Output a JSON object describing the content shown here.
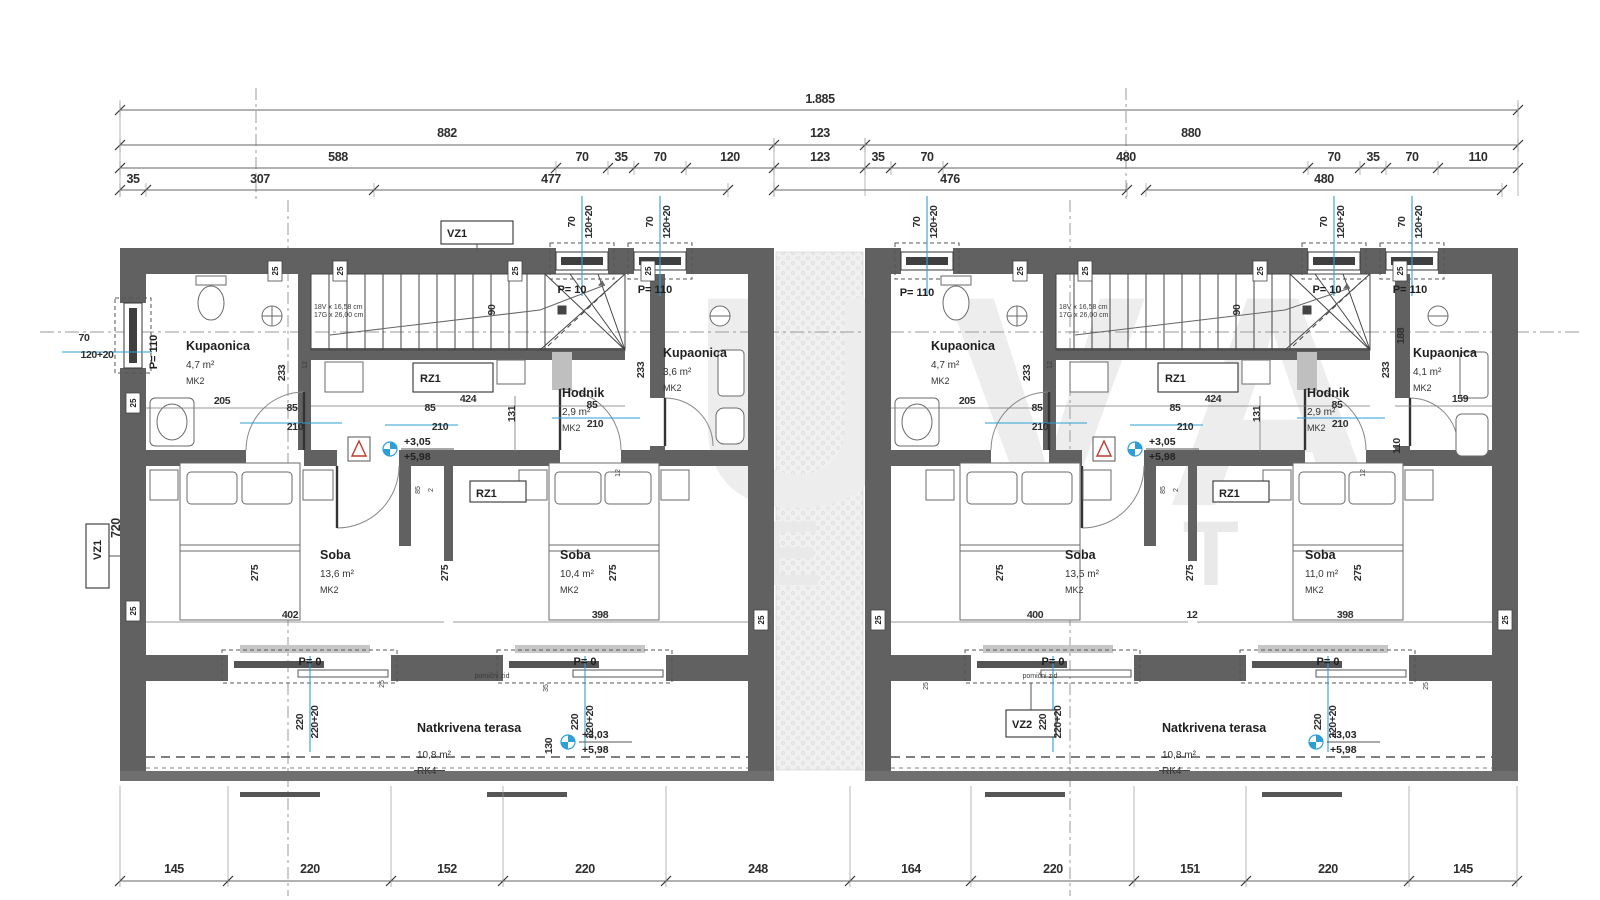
{
  "watermark": {
    "big": "UVA",
    "small": "EST"
  },
  "rooms": [
    {
      "name": "Kupaonica",
      "area": "4,7 m²",
      "cls": "MK2",
      "x": 186,
      "y": 350
    },
    {
      "name": "Hodnik",
      "area": "2,9 m²",
      "cls": "MK2",
      "x": 562,
      "y": 397
    },
    {
      "name": "Kupaonica",
      "area": "3,6 m²",
      "cls": "MK2",
      "x": 663,
      "y": 357
    },
    {
      "name": "Soba",
      "area": "13,6 m²",
      "cls": "MK2",
      "x": 320,
      "y": 559
    },
    {
      "name": "Soba",
      "area": "10,4 m²",
      "cls": "MK2",
      "x": 560,
      "y": 559
    },
    {
      "name": "Kupaonica",
      "area": "4,7 m²",
      "cls": "MK2",
      "x": 931,
      "y": 350
    },
    {
      "name": "Hodnik",
      "area": "2,9 m²",
      "cls": "MK2",
      "x": 1307,
      "y": 397
    },
    {
      "name": "Kupaonica",
      "area": "4,1 m²",
      "cls": "MK2",
      "x": 1413,
      "y": 357
    },
    {
      "name": "Soba",
      "area": "13,5 m²",
      "cls": "MK2",
      "x": 1065,
      "y": 559
    },
    {
      "name": "Soba",
      "area": "11,0 m²",
      "cls": "MK2",
      "x": 1305,
      "y": 559
    }
  ],
  "terrace": [
    {
      "name": "Natkrivena terasa",
      "area": "10,8 m²",
      "note": "RK4",
      "x": 417,
      "y": 732
    },
    {
      "name": "Natkrivena terasa",
      "area": "10,8 m²",
      "note": "RK4",
      "x": 1162,
      "y": 732
    }
  ],
  "levels": [
    {
      "x": 390,
      "y": 449,
      "above": "+3,05",
      "below": "+5,98"
    },
    {
      "x": 1135,
      "y": 449,
      "above": "+3,05",
      "below": "+5,98"
    },
    {
      "x": 568,
      "y": 742,
      "above": "+3,03",
      "below": "+5,98"
    },
    {
      "x": 1316,
      "y": 742,
      "above": "+3,03",
      "below": "+5,98"
    }
  ],
  "stairs_text": [
    {
      "l1": "18V x 16,58 cm",
      "l2": "17G x 26,00 cm",
      "x": 314,
      "y": 309
    },
    {
      "l1": "18V x 16,58 cm",
      "l2": "17G x 26,00 cm",
      "x": 1059,
      "y": 309
    }
  ],
  "code_boxes": [
    [
      "RZ1",
      413,
      363,
      80,
      29,
      420,
      382,
      0
    ],
    [
      "RZ1",
      470,
      481,
      56,
      21,
      476,
      497,
      0
    ],
    [
      "RZ1",
      1158,
      363,
      80,
      29,
      1165,
      382,
      0
    ],
    [
      "RZ1",
      1213,
      481,
      56,
      21,
      1219,
      497,
      0
    ],
    [
      "VZ1",
      441,
      221,
      72,
      23,
      447,
      237,
      0
    ],
    [
      "VZ2",
      1006,
      710,
      50,
      27,
      1012,
      728,
      0
    ],
    [
      "VZ1",
      86,
      524,
      23,
      64,
      101,
      560,
      -90
    ]
  ],
  "wall_markers": [
    {
      "t": "25",
      "x": 275,
      "y": 271
    },
    {
      "t": "25",
      "x": 340,
      "y": 271
    },
    {
      "t": "25",
      "x": 515,
      "y": 271
    },
    {
      "t": "25",
      "x": 648,
      "y": 271
    },
    {
      "t": "25",
      "x": 1020,
      "y": 271
    },
    {
      "t": "25",
      "x": 1085,
      "y": 271
    },
    {
      "t": "25",
      "x": 1260,
      "y": 271
    },
    {
      "t": "25",
      "x": 1400,
      "y": 271
    },
    {
      "t": "25",
      "x": 133,
      "y": 403
    },
    {
      "t": "25",
      "x": 133,
      "y": 611
    },
    {
      "t": "25",
      "x": 761,
      "y": 620
    },
    {
      "t": "25",
      "x": 878,
      "y": 620
    },
    {
      "t": "25",
      "x": 1505,
      "y": 620
    }
  ],
  "labels": {
    "dims_row1": [
      [
        "1.885",
        820,
        103,
        "d"
      ]
    ],
    "dims_row2": [
      [
        "882",
        447,
        137,
        "d"
      ],
      [
        "123",
        820,
        137,
        "d"
      ],
      [
        "880",
        1191,
        137,
        "d"
      ]
    ],
    "dims_row3": [
      [
        "588",
        338,
        161,
        "d"
      ],
      [
        "70",
        582,
        161,
        "d"
      ],
      [
        "35",
        621,
        161,
        "d"
      ],
      [
        "70",
        660,
        161,
        "d"
      ],
      [
        "120",
        730,
        161,
        "d"
      ],
      [
        "123",
        820,
        161,
        "d"
      ],
      [
        "35",
        878,
        161,
        "d"
      ],
      [
        "70",
        927,
        161,
        "d"
      ],
      [
        "480",
        1126,
        161,
        "d"
      ],
      [
        "70",
        1334,
        161,
        "d"
      ],
      [
        "35",
        1373,
        161,
        "d"
      ],
      [
        "70",
        1412,
        161,
        "d"
      ],
      [
        "110",
        1478,
        161,
        "d"
      ]
    ],
    "dims_row4": [
      [
        "35",
        133,
        183,
        "d"
      ],
      [
        "307",
        260,
        183,
        "d"
      ],
      [
        "477",
        551,
        183,
        "d"
      ],
      [
        "476",
        950,
        183,
        "d"
      ],
      [
        "480",
        1324,
        183,
        "d"
      ]
    ],
    "dims_bottom": [
      [
        "145",
        174,
        873,
        "d"
      ],
      [
        "220",
        310,
        873,
        "d"
      ],
      [
        "152",
        447,
        873,
        "d"
      ],
      [
        "220",
        585,
        873,
        "d"
      ],
      [
        "248",
        758,
        873,
        "d"
      ],
      [
        "164",
        911,
        873,
        "d"
      ],
      [
        "220",
        1053,
        873,
        "d"
      ],
      [
        "151",
        1190,
        873,
        "d"
      ],
      [
        "220",
        1328,
        873,
        "d"
      ],
      [
        "145",
        1463,
        873,
        "d"
      ]
    ],
    "window_dims": [
      [
        "70",
        575,
        222,
        "ds",
        -90
      ],
      [
        "120+20",
        592,
        222,
        "ds",
        -90
      ],
      [
        "70",
        653,
        222,
        "ds",
        -90
      ],
      [
        "120+20",
        670,
        222,
        "ds",
        -90
      ],
      [
        "70",
        920,
        222,
        "ds",
        -90
      ],
      [
        "120+20",
        937,
        222,
        "ds",
        -90
      ],
      [
        "70",
        1327,
        222,
        "ds",
        -90
      ],
      [
        "120+20",
        1344,
        222,
        "ds",
        -90
      ],
      [
        "70",
        1405,
        222,
        "ds",
        -90
      ],
      [
        "120+20",
        1422,
        222,
        "ds",
        -90
      ],
      [
        "70",
        84,
        341,
        "ds",
        0
      ],
      [
        "120+20",
        97,
        358,
        "ds",
        0
      ]
    ],
    "opening_codes": [
      [
        "P= 10",
        572,
        293,
        "c",
        0
      ],
      [
        "P= 110",
        655,
        293,
        "c",
        0
      ],
      [
        "P= 110",
        917,
        296,
        "c",
        0
      ],
      [
        "P= 10",
        1327,
        293,
        "c",
        0
      ],
      [
        "P= 110",
        1410,
        293,
        "c",
        0
      ],
      [
        "P= 110",
        157,
        352,
        "c",
        -90
      ],
      [
        "P= 0",
        310,
        665,
        "c",
        0
      ],
      [
        "P= 0",
        585,
        665,
        "c",
        0
      ],
      [
        "P= 0",
        1053,
        665,
        "c",
        0
      ],
      [
        "P= 0",
        1328,
        665,
        "c",
        0
      ]
    ],
    "slider_dims": [
      [
        "220",
        303,
        722,
        "ds",
        -90
      ],
      [
        "220+20",
        318,
        722,
        "ds",
        -90
      ],
      [
        "220",
        578,
        722,
        "ds",
        -90
      ],
      [
        "220+20",
        593,
        722,
        "ds",
        -90
      ],
      [
        "220",
        1046,
        722,
        "ds",
        -90
      ],
      [
        "220+20",
        1061,
        722,
        "ds",
        -90
      ],
      [
        "220",
        1321,
        722,
        "ds",
        -90
      ],
      [
        "220+20",
        1336,
        722,
        "ds",
        -90
      ]
    ],
    "interior_dims": [
      [
        "205",
        222,
        404,
        "ds",
        0
      ],
      [
        "85",
        292,
        411,
        "ds",
        0
      ],
      [
        "210",
        295,
        430,
        "ds",
        0
      ],
      [
        "424",
        468,
        402,
        "ds",
        0
      ],
      [
        "85",
        430,
        411,
        "ds",
        0
      ],
      [
        "210",
        440,
        430,
        "ds",
        0
      ],
      [
        "131",
        515,
        414,
        "ds",
        -90
      ],
      [
        "85",
        592,
        408,
        "ds",
        0
      ],
      [
        "210",
        595,
        427,
        "ds",
        0
      ],
      [
        "233",
        285,
        373,
        "ds",
        -90
      ],
      [
        "233",
        644,
        370,
        "ds",
        -90
      ],
      [
        "12",
        307,
        365,
        "t",
        -90
      ],
      [
        "12",
        620,
        473,
        "t",
        -90
      ],
      [
        "90",
        495,
        310,
        "ds",
        -90
      ],
      [
        "402",
        290,
        618,
        "ds",
        0
      ],
      [
        "398",
        600,
        618,
        "ds",
        0
      ],
      [
        "275",
        258,
        573,
        "ds",
        -90
      ],
      [
        "275",
        448,
        573,
        "ds",
        -90
      ],
      [
        "275",
        616,
        573,
        "ds",
        -90
      ],
      [
        "85",
        420,
        490,
        "t",
        -90
      ],
      [
        "2",
        433,
        490,
        "t",
        -90
      ],
      [
        "720",
        120,
        528,
        "d",
        -90
      ],
      [
        "130",
        552,
        746,
        "ds",
        -90
      ],
      [
        "25",
        384,
        684,
        "t",
        -90
      ],
      [
        "35",
        548,
        688,
        "t",
        -90
      ],
      [
        "205",
        967,
        404,
        "ds",
        0
      ],
      [
        "85",
        1037,
        411,
        "ds",
        0
      ],
      [
        "210",
        1040,
        430,
        "ds",
        0
      ],
      [
        "424",
        1213,
        402,
        "ds",
        0
      ],
      [
        "85",
        1175,
        411,
        "ds",
        0
      ],
      [
        "210",
        1185,
        430,
        "ds",
        0
      ],
      [
        "131",
        1260,
        414,
        "ds",
        -90
      ],
      [
        "85",
        1337,
        408,
        "ds",
        0
      ],
      [
        "210",
        1340,
        427,
        "ds",
        0
      ],
      [
        "233",
        1030,
        373,
        "ds",
        -90
      ],
      [
        "233",
        1389,
        370,
        "ds",
        -90
      ],
      [
        "12",
        1052,
        365,
        "t",
        -90
      ],
      [
        "12",
        1365,
        473,
        "t",
        -90
      ],
      [
        "90",
        1240,
        310,
        "ds",
        -90
      ],
      [
        "400",
        1035,
        618,
        "ds",
        0
      ],
      [
        "12",
        1192,
        618,
        "ds",
        0
      ],
      [
        "398",
        1345,
        618,
        "ds",
        0
      ],
      [
        "275",
        1003,
        573,
        "ds",
        -90
      ],
      [
        "275",
        1193,
        573,
        "ds",
        -90
      ],
      [
        "275",
        1361,
        573,
        "ds",
        -90
      ],
      [
        "85",
        1165,
        490,
        "t",
        -90
      ],
      [
        "2",
        1178,
        490,
        "t",
        -90
      ],
      [
        "110",
        1400,
        446,
        "ds",
        -90
      ],
      [
        "188",
        1404,
        336,
        "ds",
        -90
      ],
      [
        "159",
        1460,
        402,
        "ds",
        0
      ],
      [
        "25",
        928,
        686,
        "t",
        -90
      ],
      [
        "25",
        1428,
        686,
        "t",
        -90
      ]
    ],
    "notes": [
      [
        "pomični zid",
        492,
        678,
        "t",
        0
      ],
      [
        "pomični zid",
        1040,
        678,
        "t",
        0
      ]
    ]
  }
}
